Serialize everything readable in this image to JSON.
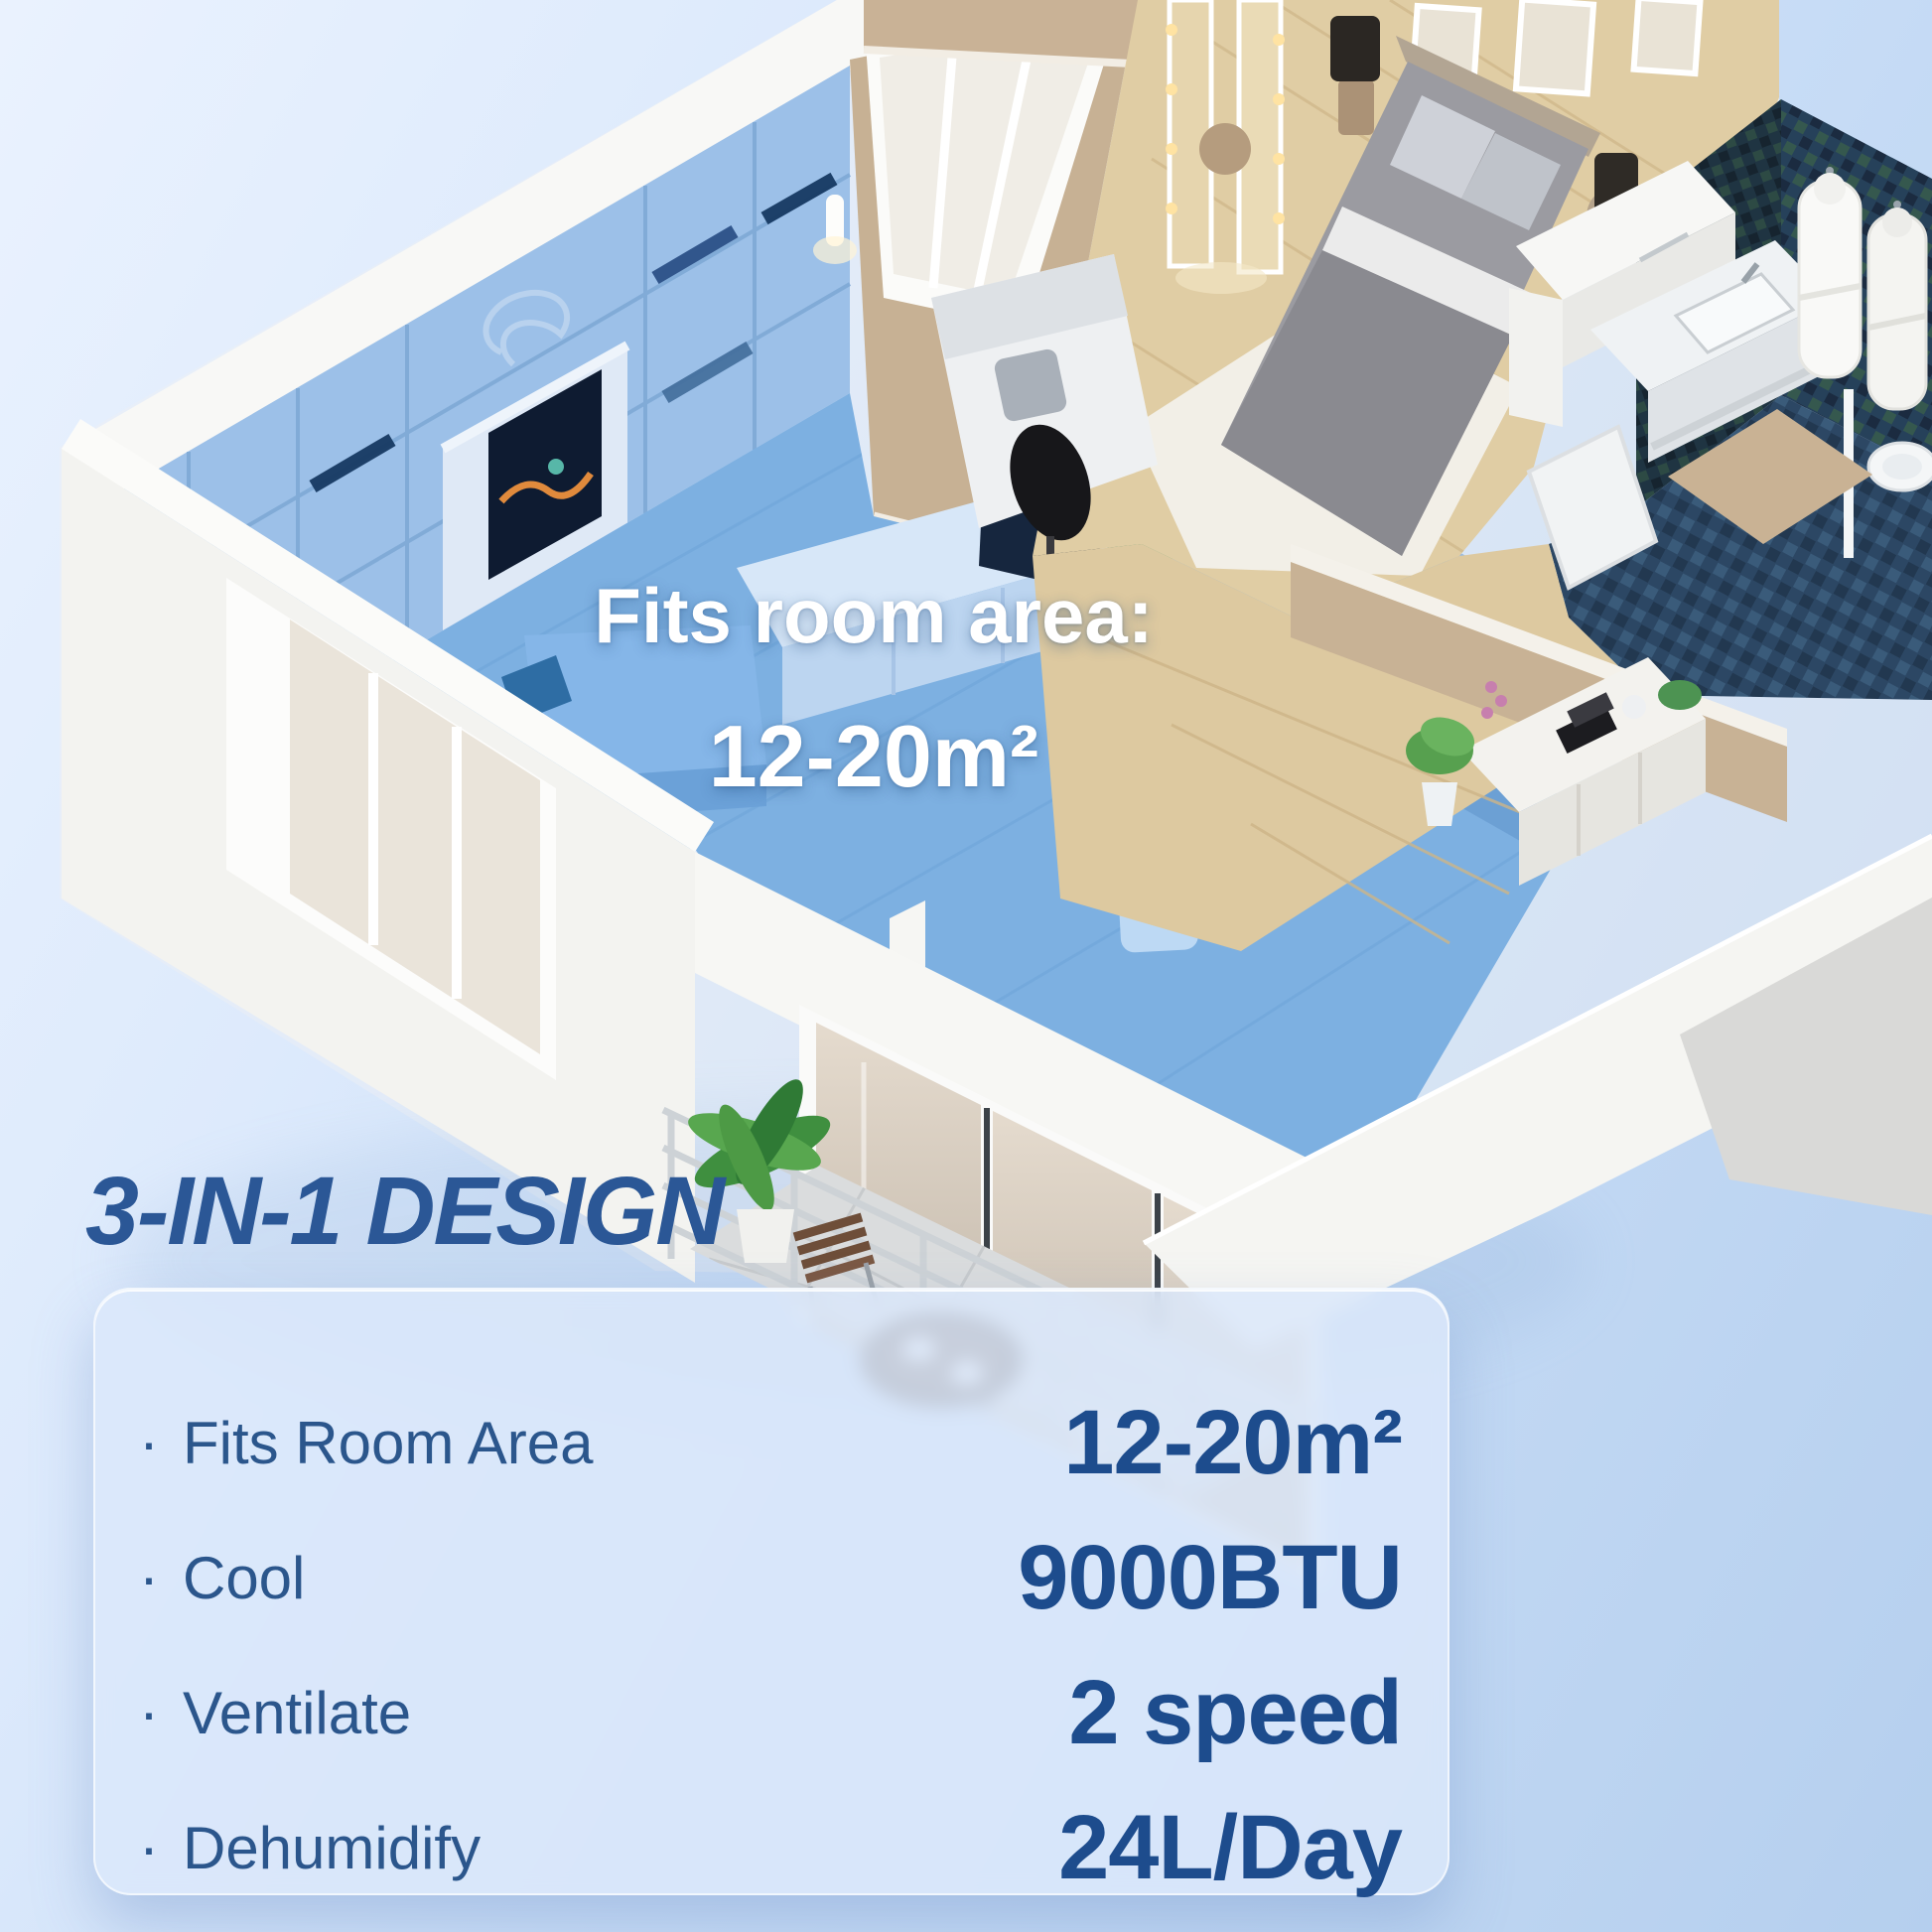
{
  "section": {
    "heading": "3-IN-1 DESIGN"
  },
  "floor_plan": {
    "overlay_line1": "Fits room area:",
    "overlay_line2": "12-20m²"
  },
  "card": {
    "bullet": "·",
    "features": [
      {
        "label": "Fits Room Area",
        "value": "12-20m²"
      },
      {
        "label": "Cool",
        "value": "9000BTU"
      },
      {
        "label": "Ventilate",
        "value": "2 speed"
      },
      {
        "label": "Dehumidify",
        "value": "24L/Day"
      }
    ]
  },
  "colors": {
    "heading_blue": "#2b5796",
    "label_blue": "#2b568c",
    "value_blue": "#1d4c8d",
    "overlay_text": "#ffffff",
    "room_highlight": "#7db0e1",
    "card_background": "#dbe7fa",
    "background_top": "#eaf2fe",
    "background_bottom": "#b5cfee",
    "wood_floor": "#ddc9a0",
    "bathroom_tile": "#26415a"
  }
}
